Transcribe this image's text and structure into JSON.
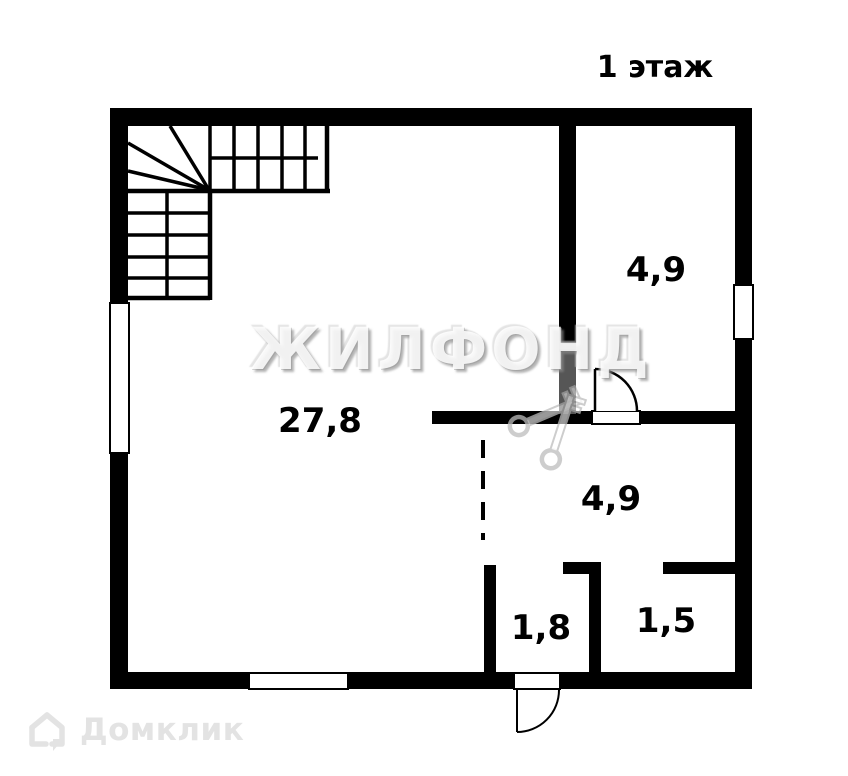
{
  "title": "1 этаж",
  "rooms": [
    {
      "name": "living-room",
      "area": "27,8"
    },
    {
      "name": "room-top-right",
      "area": "4,9"
    },
    {
      "name": "room-middle-right",
      "area": "4,9"
    },
    {
      "name": "closet-bottom",
      "area": "1,8"
    },
    {
      "name": "entry-bottom",
      "area": "1,5"
    }
  ],
  "watermarks": {
    "agency": "ЖИЛФОНД",
    "portal": "Домклик"
  },
  "colors": {
    "wall": "#000000",
    "background": "#ffffff",
    "emboss_shadow": "#8c8c8c",
    "keys_gray": "#bdbdbd",
    "logo_gray": "#e3e3e3"
  }
}
